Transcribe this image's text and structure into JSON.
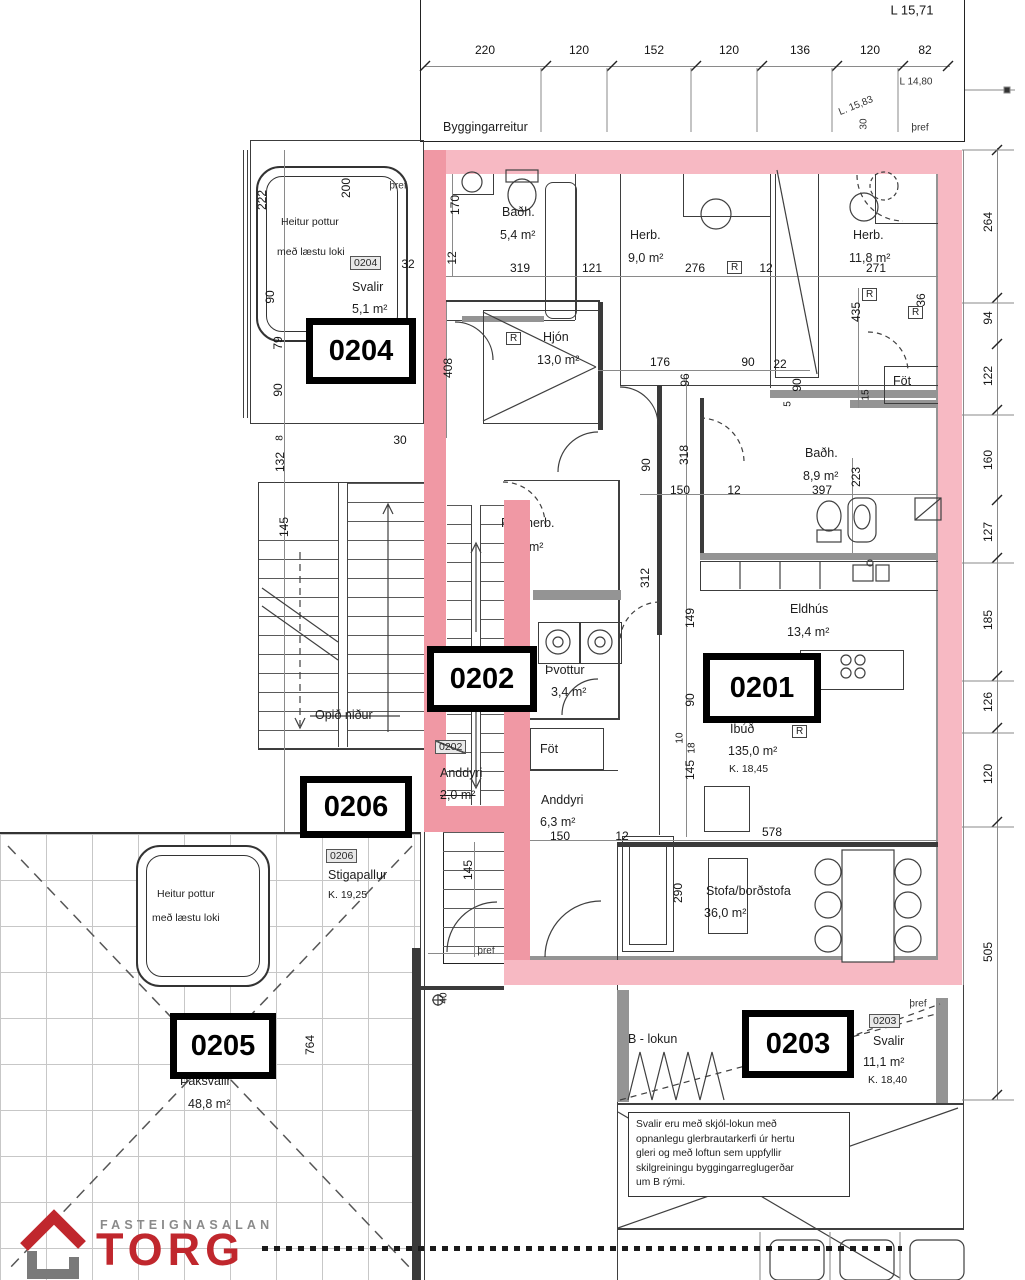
{
  "colors": {
    "pink": "#f7b9c3",
    "pink2": "#f098a4",
    "red": "#c0272d"
  },
  "plot": {
    "label": "Byggingarreitur",
    "dims": [
      "220",
      "120",
      "152",
      "120",
      "136",
      "120",
      "82"
    ],
    "level_top": "L 15,71",
    "level_a": "L 14,80",
    "level_b": "L. 15,83",
    "dim_30": "30"
  },
  "labels": {
    "thref": "þref",
    "tag_extra": "32"
  },
  "chain": [
    "264",
    "94",
    "122",
    "160",
    "127",
    "185",
    "126",
    "120",
    "505"
  ],
  "dims": [
    "170",
    "12",
    "319",
    "121",
    "276",
    "12",
    "271",
    "36",
    "408",
    "176",
    "96",
    "90",
    "22",
    "90",
    "5",
    "435",
    "15",
    "90",
    "318",
    "150",
    "12",
    "397",
    "223",
    "312",
    "149",
    "90",
    "10",
    "18",
    "145",
    "150",
    "12",
    "578",
    "290",
    "222",
    "200",
    "90",
    "79",
    "90",
    "132",
    "8",
    "145",
    "30",
    "145",
    "40",
    "764"
  ],
  "units": {
    "u0204": {
      "id": "0204",
      "room": "Svalir",
      "area": "5,1 m²",
      "tag": "0204"
    },
    "u0202": {
      "id": "0202",
      "room": "Anddyri",
      "area": "2,0 m²",
      "tag": "0202"
    },
    "u0201": {
      "id": "0201",
      "room": "Íbúð",
      "area": "135,0 m²",
      "level": "K. 18,45"
    },
    "u0206": {
      "id": "0206",
      "room": "Stigapallur",
      "level": "K. 19,25",
      "tag": "0206"
    },
    "u0205": {
      "id": "0205",
      "room": "Þaksvalir",
      "area": "48,8 m²"
    },
    "u0203": {
      "id": "0203",
      "room": "Svalir",
      "area": "11,1 m²",
      "level": "K. 18,40",
      "tag": "0203"
    }
  },
  "rooms": {
    "badh1": {
      "name": "Baðh.",
      "area": "5,4 m²"
    },
    "herb1": {
      "name": "Herb.",
      "area": "9,0 m²"
    },
    "herb2": {
      "name": "Herb.",
      "area": "11,8 m²"
    },
    "hjon": {
      "name": "Hjón",
      "area": "13,0 m²"
    },
    "badh2": {
      "name": "Baðh.",
      "area": "8,9 m²"
    },
    "eldhus": {
      "name": "Eldhús",
      "area": "13,4 m²"
    },
    "fataherb": {
      "name": "Fataherb.",
      "area": ",4 m²"
    },
    "thvottur": {
      "name": "Þvottur",
      "area": "3,4 m²"
    },
    "anddyri2": {
      "name": "Anddyri",
      "area": "6,3 m²"
    },
    "stofa": {
      "name": "Stofa/borðstofa",
      "area": "36,0 m²"
    },
    "fot": "Föt",
    "hot_tub_line1": "Heitur pottur",
    "hot_tub_line2": "með læstu loki",
    "opid_nidur": "Opið niður",
    "b_lokun": "B - lokun",
    "r_marker": "R"
  },
  "note": {
    "lines": [
      "Svalir eru með skjól-lokun með",
      "opnanlegu glerbrautarkerfi úr hertu",
      "gleri og með loftun sem uppfyllir",
      "skilgreiningu byggingarreglugerðar",
      "um B rými."
    ]
  },
  "logo": {
    "top": "FASTEIGNASALAN",
    "main": "TORG"
  }
}
